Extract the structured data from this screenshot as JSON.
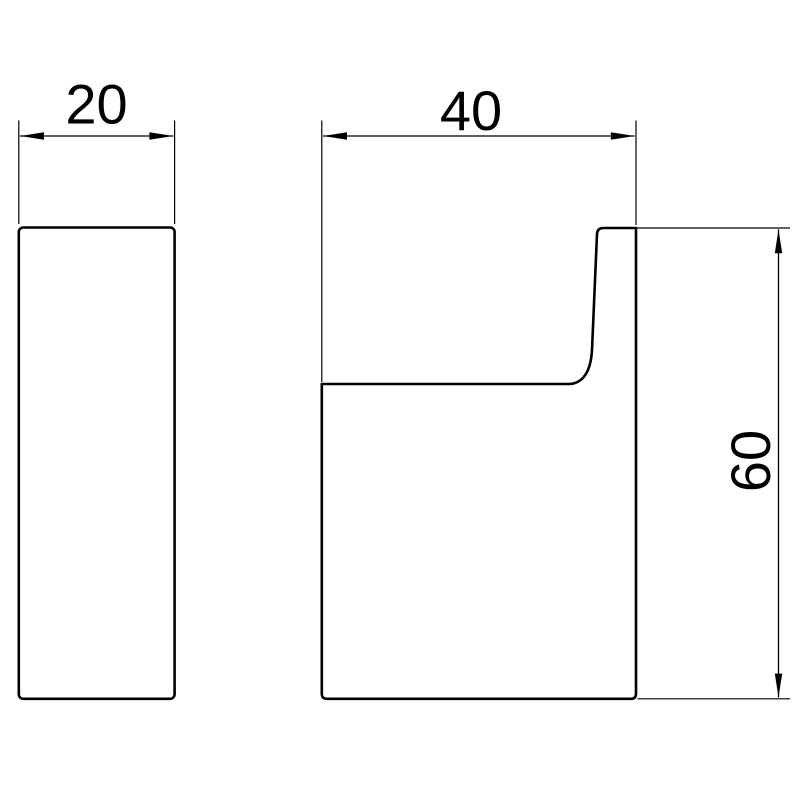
{
  "drawing": {
    "title": "robe-hook-dimension-drawing",
    "colors": {
      "background": "#ffffff",
      "line": "#000000"
    },
    "dimensions": {
      "side_view_width": "20",
      "front_view_width": "40",
      "front_view_height": "60"
    }
  }
}
